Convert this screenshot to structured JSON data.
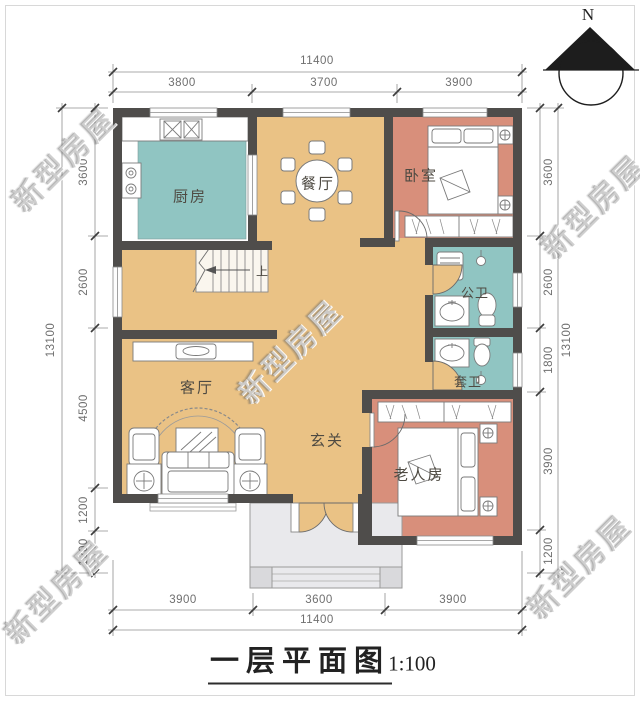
{
  "title": {
    "text": "一层平面图",
    "scale": "1:100"
  },
  "north_indicator": {
    "label": "N"
  },
  "watermark": {
    "text": "新型房屋"
  },
  "rooms": {
    "kitchen": "厨房",
    "dining": "餐厅",
    "bedroom": "卧室",
    "public_bath": "公卫",
    "ensuite_bath": "套卫",
    "living": "客厅",
    "foyer": "玄关",
    "elder_room": "老人房",
    "stair_up": "上"
  },
  "dimensions": {
    "top": {
      "overall": "11400",
      "segments": [
        "3800",
        "3700",
        "3900"
      ]
    },
    "bottom": {
      "overall": "11400",
      "segments": [
        "3900",
        "3600",
        "3900"
      ]
    },
    "left": {
      "overall": "13100",
      "segments": [
        "3600",
        "2600",
        "4500",
        "1200",
        "1200"
      ]
    },
    "right": {
      "overall": "13100",
      "segments": [
        "3600",
        "2600",
        "1800",
        "3900",
        "1200"
      ]
    }
  },
  "colors": {
    "wall": "#4f4d4b",
    "floor_hall": "#eac285",
    "floor_kitchen_bath": "#90c5c2",
    "floor_bedroom": "#d88f7b",
    "porch": "#e9e9ec",
    "porch_base": "#d9d9dc"
  }
}
